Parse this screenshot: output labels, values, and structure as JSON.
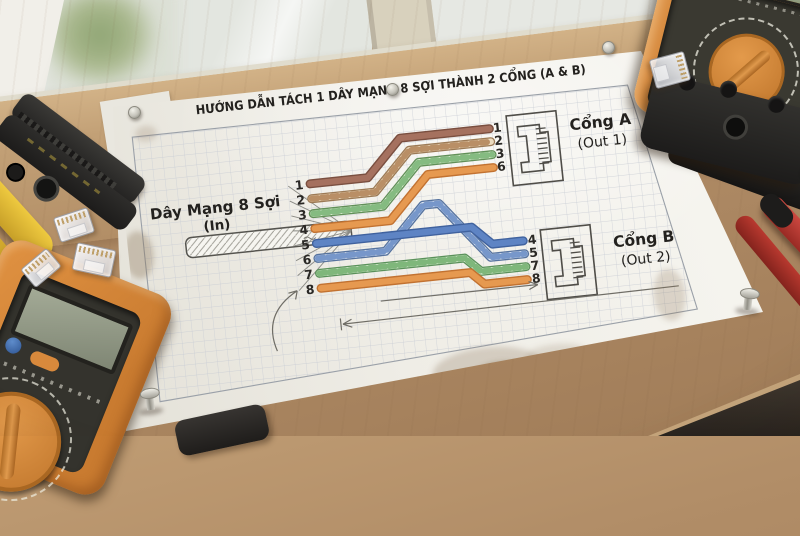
{
  "diagram": {
    "title": "HƯỚNG DẪN TÁCH 1 DÂY MẠNG 8 SỢI THÀNH 2 CỔNG (A & B)",
    "input": {
      "label": "Dây Mạng 8 Sợi",
      "sublabel": "(In)",
      "pins": [
        "1",
        "2",
        "3",
        "4",
        "5",
        "6",
        "7",
        "8"
      ]
    },
    "port_a": {
      "name": "Cổng A",
      "sublabel": "(Out 1)",
      "pins": [
        "1",
        "2",
        "3",
        "6"
      ]
    },
    "port_b": {
      "name": "Cổng B",
      "sublabel": "(Out 2)",
      "pins": [
        "4",
        "5",
        "7",
        "8"
      ]
    }
  },
  "colors": {
    "ink": "#23211e",
    "pencil": "#6f6d66",
    "grid": "#c7ccd4",
    "border": "#9aa0a8",
    "jack": "#4f4d48",
    "wire_brown": "#a5715f",
    "wire_brown_dark": "#7a4f40",
    "wire_brownwhite_base": "#ecdcc0",
    "wire_brownwhite_stripe": "#b08156",
    "wire_brownwhite_dark": "#9c7a55",
    "wire_greenwhite_base": "#e4f0da",
    "wire_greenwhite_stripe": "#74b271",
    "wire_greenwhite_dark": "#619058",
    "wire_bluewhite_base": "#e2e9f3",
    "wire_bluewhite_stripe": "#6488c2",
    "wire_bluewhite_dark": "#56739f",
    "wire_blue": "#5e84c4",
    "wire_blue_dark": "#40629e",
    "wire_green_base": "#daecd2",
    "wire_green_stripe": "#6fae6c",
    "wire_green_dark": "#5a915a",
    "wire_orange": "#e69950",
    "wire_orange_dark": "#c27231",
    "stain": "#8a7355"
  }
}
